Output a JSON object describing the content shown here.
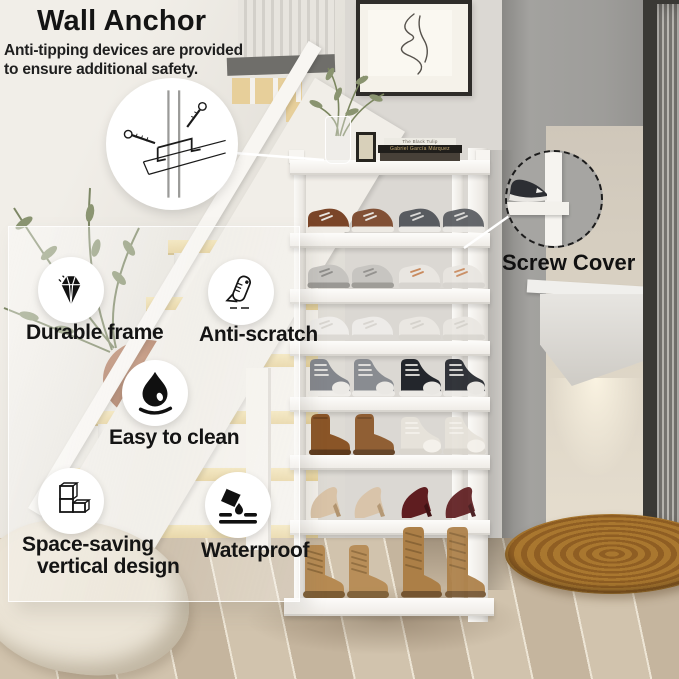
{
  "header": {
    "title": "Wall Anchor",
    "subtitle_lines": [
      "Anti-tipping devices are provided",
      "to ensure additional safety."
    ]
  },
  "callouts": {
    "screw_cover_label": "Screw Cover"
  },
  "features": [
    {
      "icon": "diamond-icon",
      "label": "Durable frame"
    },
    {
      "icon": "scraper-icon",
      "label": "Anti-scratch"
    },
    {
      "icon": "water-drop-icon",
      "label": "Easy to clean"
    },
    {
      "icon": "stacked-shelf-icon",
      "label_lines": [
        "Space-saving",
        "vertical design"
      ]
    },
    {
      "icon": "pouring-water-icon",
      "label": "Waterproof"
    }
  ],
  "colors": {
    "label_text": "#141414",
    "leader_line": "#ffffff",
    "rack_white": "#f6f4f0",
    "rug_brown": "#a9772f"
  },
  "rack": {
    "top_decor": {
      "books": [
        {
          "spine": "The Black Tulip"
        },
        {
          "spine": "Gabriel García Márquez"
        },
        {
          "spine": ""
        }
      ]
    },
    "tiers": [
      {
        "left": {
          "type": "sneaker",
          "name": "brown-sneakers",
          "body": "#7a4528",
          "accent": "#e9e5df",
          "sole": "#efece6"
        },
        "right": {
          "type": "sneaker",
          "name": "gray-sneakers",
          "body": "#585b60",
          "accent": "#d9d8d6",
          "sole": "#eceae6"
        }
      },
      {
        "left": {
          "type": "sneaker",
          "name": "gray-white-sneakers",
          "body": "#c6c4c0",
          "accent": "#8e8d8a",
          "sole": "#9a9894"
        },
        "right": {
          "type": "sneaker",
          "name": "white-tan-sneakers",
          "body": "#e9e6e1",
          "accent": "#c98a5e",
          "sole": "#d7d4cf"
        }
      },
      {
        "left": {
          "type": "sneaker",
          "name": "white-sneakers",
          "body": "#efedea",
          "accent": "#d8d5d0",
          "sole": "#dcd9d4"
        },
        "right": {
          "type": "sneaker",
          "name": "white-sneakers",
          "body": "#eae7e2",
          "accent": "#d5d2cc",
          "sole": "#d9d6d0"
        }
      },
      {
        "left": {
          "type": "hightop",
          "name": "gray-hightops",
          "body": "#83868c",
          "accent": "#eceae6",
          "sole": "#efede9"
        },
        "right": {
          "type": "hightop",
          "name": "black-hightops",
          "body": "#23262c",
          "accent": "#e9e7e3",
          "sole": "#eceae6"
        }
      },
      {
        "left": {
          "type": "boot",
          "name": "brown-ankle-boots",
          "body": "#8a5527",
          "accent": "#6e421d",
          "sole": "#5d3a1c"
        },
        "right": {
          "type": "hightop",
          "name": "white-hightops",
          "body": "#e6e2da",
          "accent": "#f4f1eb",
          "sole": "#d9d5cd"
        }
      },
      {
        "left": {
          "type": "heel",
          "name": "beige-heels",
          "body": "#d9c3a7",
          "accent": "#c5ab8a",
          "sole": "#b2946f"
        },
        "right": {
          "type": "heel",
          "name": "maroon-heels",
          "body": "#5f1d20",
          "accent": "#7a2a2e",
          "sole": "#3f1214"
        }
      },
      {
        "left": {
          "type": "combat",
          "name": "tan-combat-boots",
          "body": "#b68a52",
          "accent": "#8f6a3a",
          "sole": "#7c5c33"
        },
        "right": {
          "type": "tall",
          "name": "tan-tall-boots",
          "body": "#ac7f47",
          "accent": "#8a6536",
          "sole": "#745430"
        }
      }
    ]
  }
}
